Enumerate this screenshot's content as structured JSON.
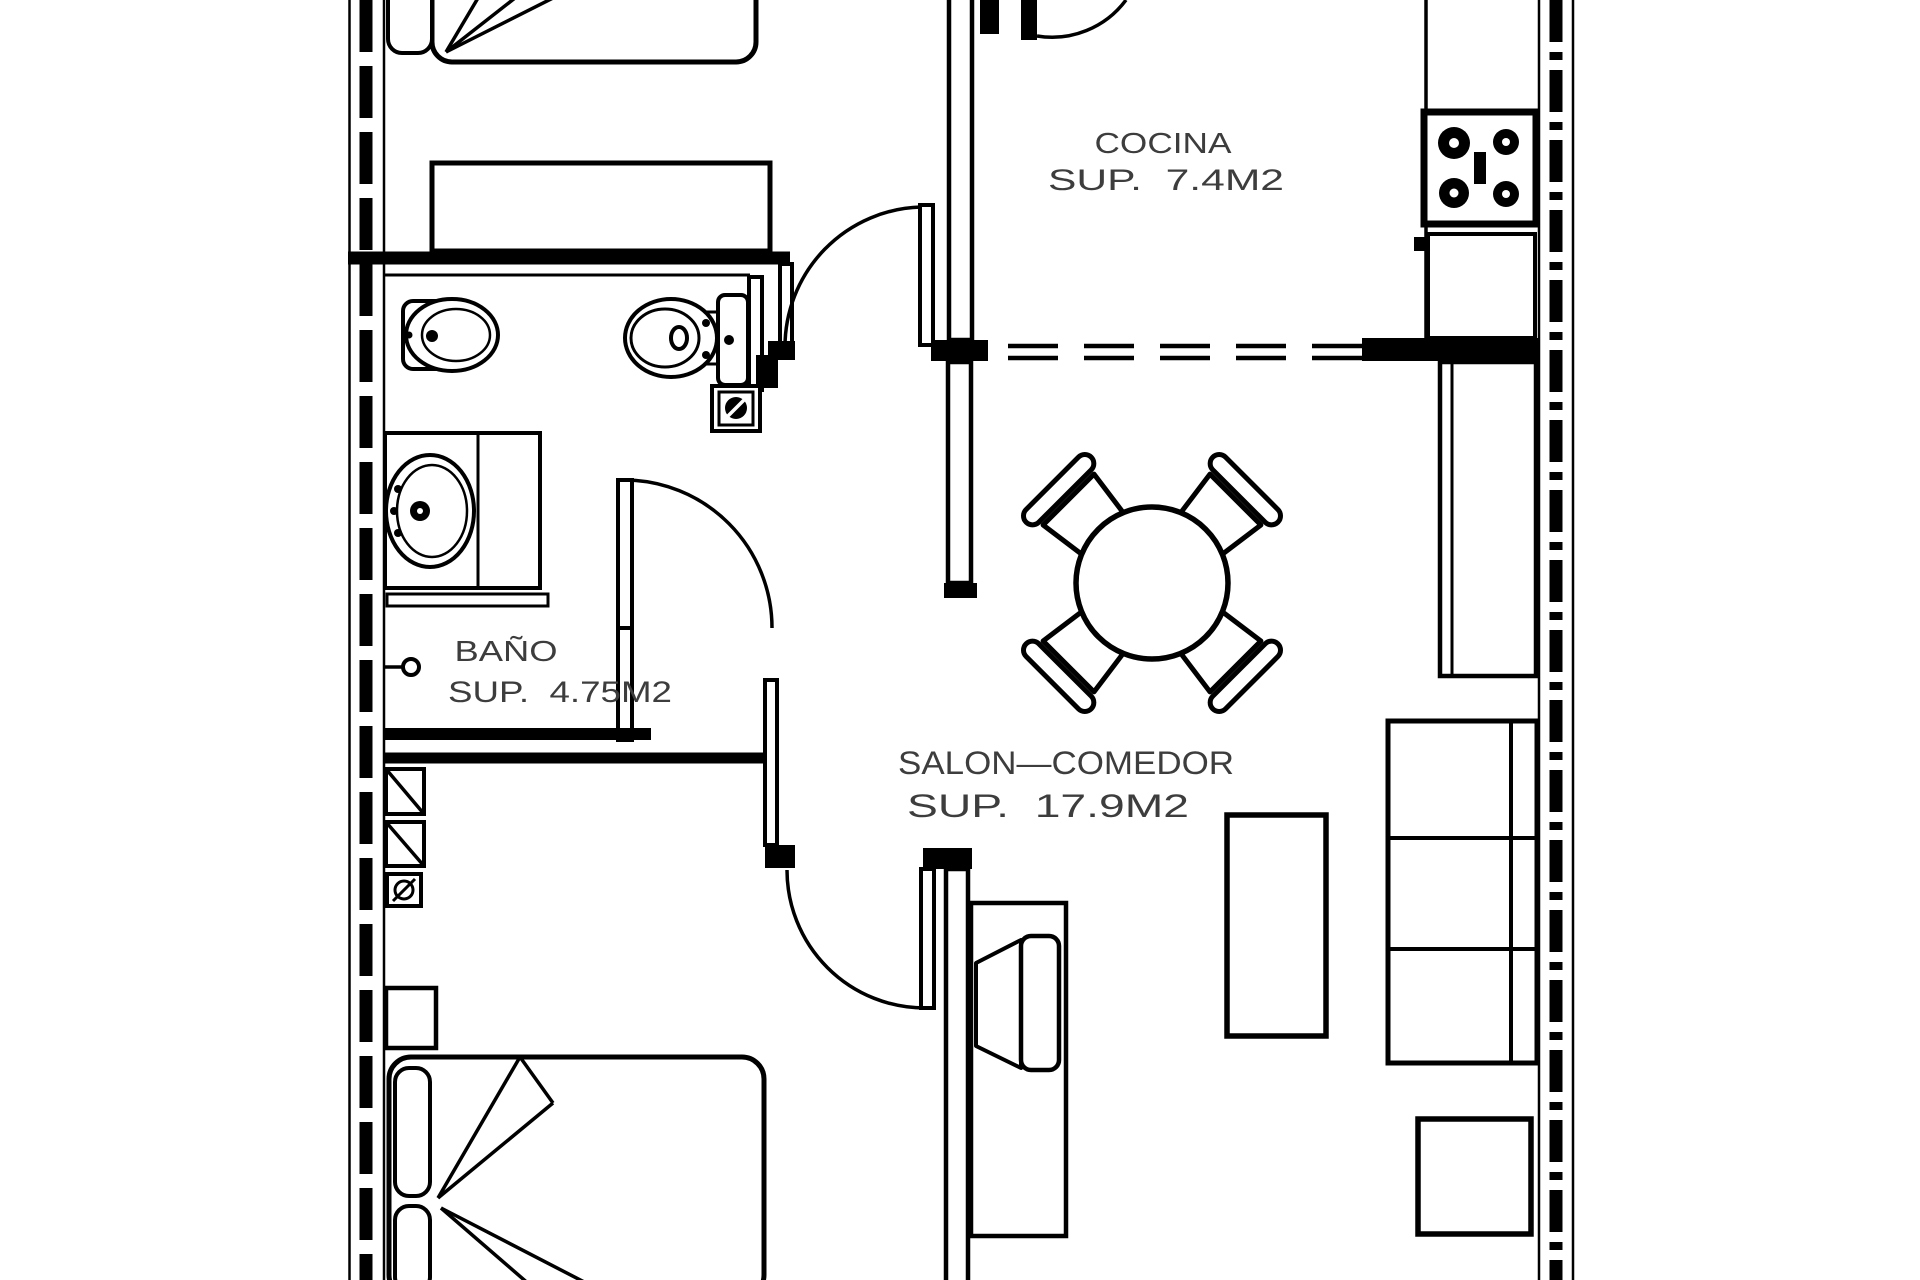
{
  "drawing": {
    "title": "apartment-floor-plan",
    "background": "#ffffff",
    "line_color": "#000000",
    "text_color": "#3d3d3d",
    "rooms": {
      "cocina": {
        "name": "COCINA",
        "area": "SUP.  7.4M2"
      },
      "bano": {
        "name": "BAÑO",
        "area": "SUP.  4.75M2"
      },
      "salon": {
        "name": "SALON—COMEDOR",
        "area": "SUP.  17.9M2"
      }
    },
    "symbols": [
      "single-bed",
      "double-bed",
      "dresser",
      "stove",
      "kitchen-counter",
      "toilet",
      "bidet",
      "washbasin",
      "floor-drain",
      "shelf",
      "switch",
      "dining-table",
      "chair",
      "sofa",
      "coffee-table",
      "tv-cabinet",
      "tv",
      "side-table",
      "tall-cabinet",
      "door-swing",
      "closet-module"
    ]
  }
}
